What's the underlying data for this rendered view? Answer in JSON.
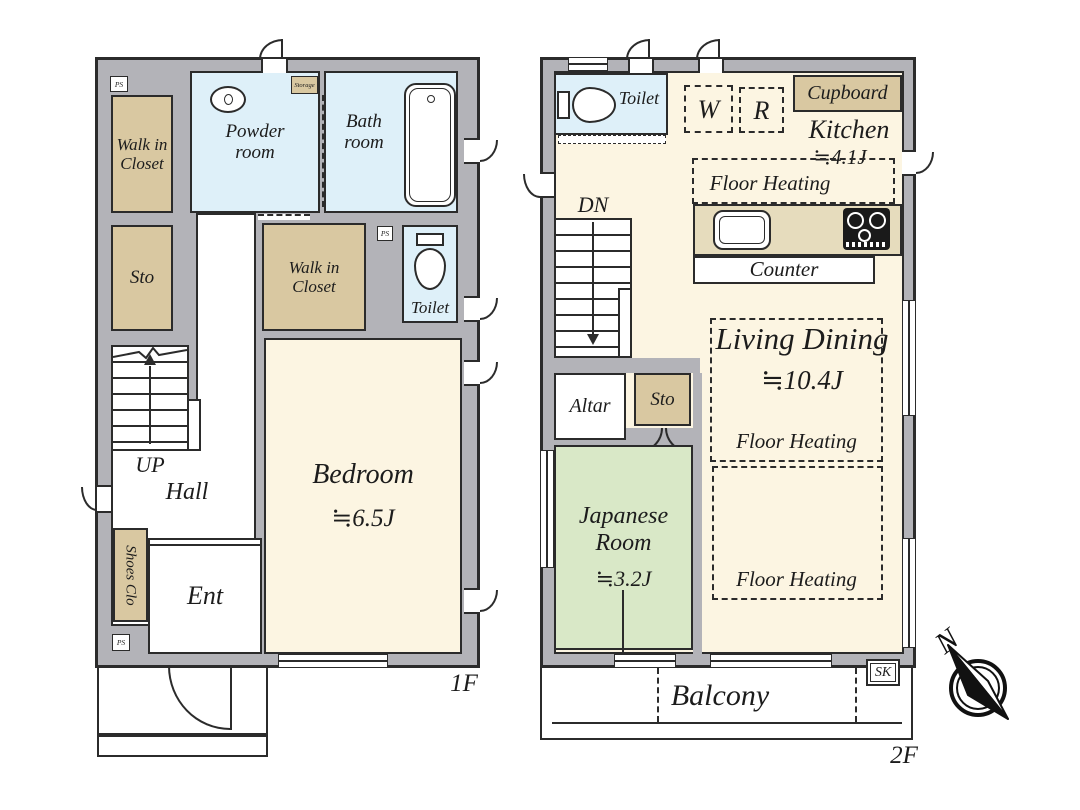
{
  "colors": {
    "wall": "#b3b3b8",
    "outline": "#2b2b2b",
    "room_cream": "#fcf5e2",
    "water_blue": "#def0f9",
    "closet_tan": "#d9c8a1",
    "tatami_green": "#d9e8c7",
    "counter_tan": "#e6dcbd",
    "stove_black": "#1a1a1a"
  },
  "floor1": {
    "label": "1F",
    "ps": "PS",
    "walk_in_closet": "Walk in Closet",
    "powder_room": "Powder room",
    "storage": "Storage",
    "bath_room": "Bath room",
    "sto": "Sto",
    "toilet": "Toilet",
    "up": "UP",
    "hall": "Hall",
    "shoes_clo": "Shoes Clo",
    "ent": "Ent",
    "bedroom": "Bedroom",
    "bedroom_size": "≒6.5J"
  },
  "floor2": {
    "label": "2F",
    "toilet": "Toilet",
    "w": "W",
    "r": "R",
    "cupboard": "Cupboard",
    "kitchen": "Kitchen",
    "kitchen_size": "≒4.1J",
    "floor_heating": "Floor Heating",
    "counter": "Counter",
    "dn": "DN",
    "altar": "Altar",
    "sto": "Sto",
    "japanese_room": "Japanese Room",
    "japanese_size": "≒3.2J",
    "living_dining": "Living Dining",
    "living_size": "≒10.4J",
    "balcony": "Balcony",
    "sk": "SK"
  },
  "compass": {
    "north": "N"
  }
}
